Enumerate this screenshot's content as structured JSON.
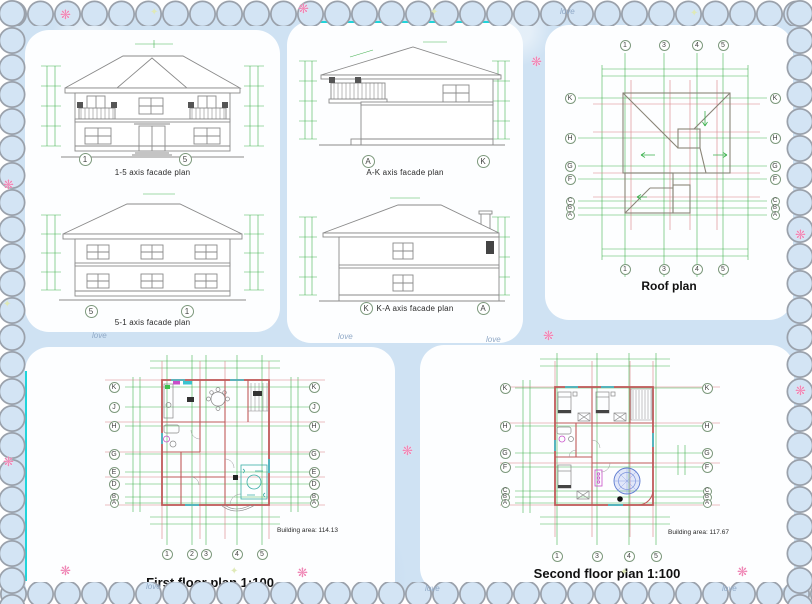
{
  "colors": {
    "mat": "#cfe2f3",
    "scallop_outline": "#9aa1ab",
    "cad_green": "#47b353",
    "cad_red": "#c05a5a",
    "accent_cyan": "#1fd4da",
    "flower_pink": "#ef86b5"
  },
  "decor": {
    "love_text": "love"
  },
  "panels": {
    "facade_15": {
      "caption": "1-5 axis facade plan",
      "marker_left": "1",
      "marker_right": "5"
    },
    "facade_51": {
      "caption": "5-1 axis facade plan",
      "marker_left": "5",
      "marker_right": "1"
    },
    "facade_ak": {
      "caption": "A-K axis facade plan",
      "marker_left": "A",
      "marker_right": "K"
    },
    "facade_ka": {
      "caption": "K-A axis facade plan",
      "marker_left": "K",
      "marker_right": "A"
    },
    "roof": {
      "title": "Roof plan",
      "cols": [
        "1",
        "3",
        "4",
        "5"
      ],
      "rows": [
        "K",
        "H",
        "G",
        "F",
        "C",
        "B",
        "A"
      ]
    },
    "first_floor": {
      "title": "First floor plan 1:100",
      "building_area": "Building area: 114.13",
      "cols": [
        "1",
        "2",
        "3",
        "4",
        "5"
      ],
      "rows": [
        "K",
        "J",
        "H",
        "G",
        "E",
        "D",
        "B",
        "A"
      ]
    },
    "second_floor": {
      "title": "Second floor plan 1:100",
      "building_area": "Building area: 117.67",
      "cols": [
        "1",
        "3",
        "4",
        "5"
      ],
      "rows": [
        "K",
        "H",
        "G",
        "F",
        "C",
        "B",
        "A"
      ]
    }
  }
}
